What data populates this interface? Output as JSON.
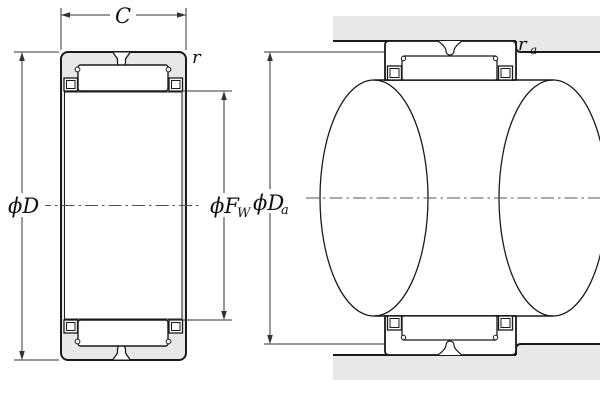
{
  "diagram_type": "needle-roller-bearing-cross-section",
  "dimensions": {
    "width_label": "C",
    "chamfer_label": "r",
    "outer_diameter_label": "ϕD",
    "raceway_diameter_label": "ϕF",
    "raceway_diameter_subscript": "W",
    "shoulder_diameter_label": "ϕD",
    "shoulder_diameter_subscript": "a",
    "fillet_radius_label": "r",
    "fillet_radius_subscript": "a"
  },
  "colors": {
    "outline": "#1a1a1a",
    "section_fill": "#e8e8e8",
    "dimension_line": "#333333",
    "center_line": "#555555",
    "background": "#ffffff"
  }
}
